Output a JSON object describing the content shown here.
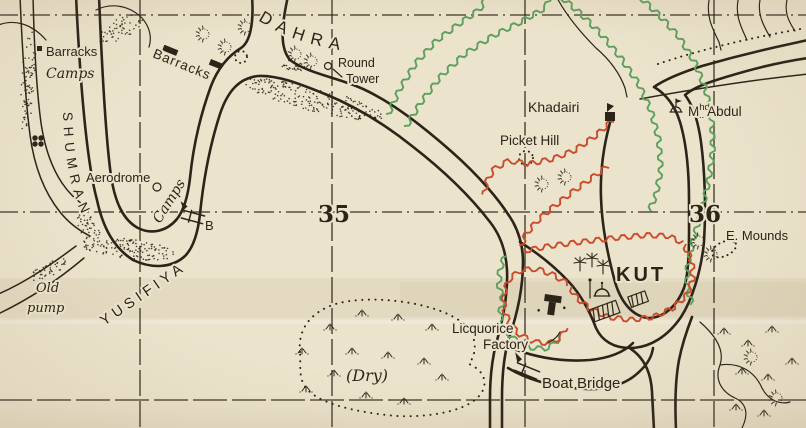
{
  "map": {
    "kind": "scanned historical siege map",
    "labels": {
      "barracks_west": "Barracks",
      "camps_west": "Camps",
      "barracks_east": "Barracks",
      "shumran": "SHUMRAN",
      "dahra": "DAHRA",
      "round_tower_line1": "Round",
      "round_tower_line2": "Tower",
      "aerodrome": "Aerodrome",
      "camps_aerodrome": "Camps",
      "bridge_b": "B",
      "grid_35": "35",
      "grid_36": "36",
      "khadairi": "Khadairi",
      "picket_hill": "Picket Hill",
      "mhd_m": "M",
      "mhd_sup": "hd",
      "mhd_dots": "..",
      "mhd_rest": "Abdul",
      "e_mounds": "E. Mounds",
      "kut": "KUT",
      "licquorice_line1": "Licquorice",
      "licquorice_line2": "Factory",
      "boat_bridge": "Boat Bridge",
      "dry": "(Dry)",
      "old_pump_line1": "Old",
      "old_pump_line2": "pump",
      "yusifiya": "YUSIFIYA"
    },
    "grid_squares": {
      "west": "35",
      "east": "36"
    }
  },
  "colors": {
    "paper": "#ece3cc",
    "ink": "#2c2418",
    "trench_red": "#cb4c2b",
    "trench_green": "#5da05f"
  },
  "icons": {
    "barracks-block-icon": "small solid black rectangle",
    "fort-icon": "black quatrefoil cluster",
    "round-tower-icon": "small open circle",
    "aerodrome-icon": "small open circle",
    "boat-bridge-icon": "double bar with pennant across river",
    "shrine-icon": "dome with flag mast",
    "mosque-icon": "dome and minaret",
    "town-blocks-icon": "hatched parallelograms",
    "factory-icon": "solid T-shaped building",
    "mound-icon": "dotted circle with radial hachures",
    "marsh-tuft-icon": "small grass tuft strokes",
    "trench-red-icon": "red crenellated line",
    "trench-green-icon": "green crenellated line"
  }
}
